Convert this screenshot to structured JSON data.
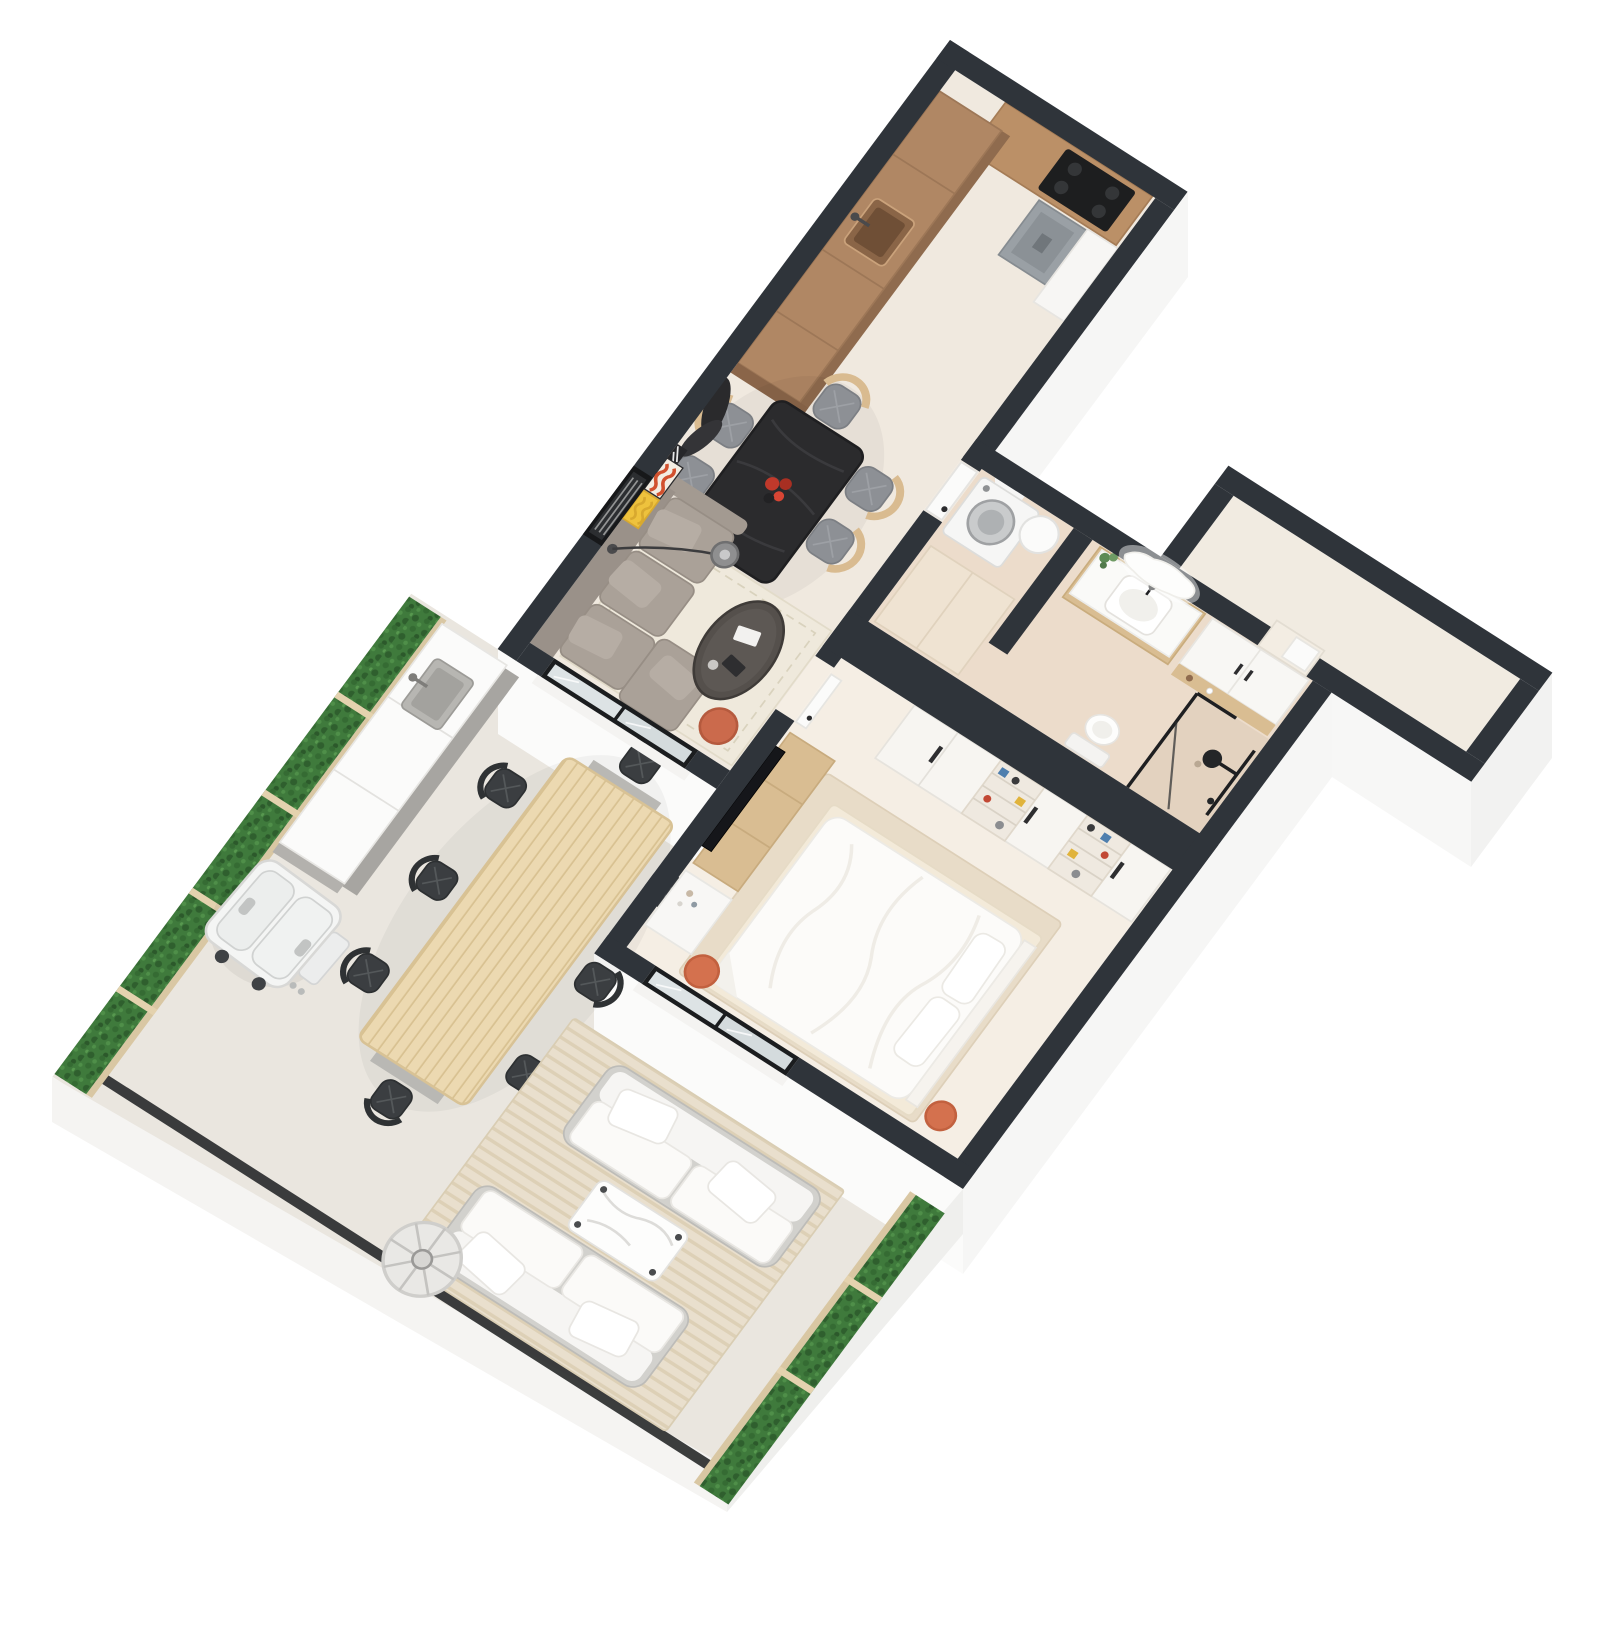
{
  "scene": {
    "type": "3d-floor-plan",
    "projection": "axonometric-top-down",
    "description": "3D axonometric floor plan of a one-bedroom apartment with open kitchen-dining-living area, bedroom, bathroom with laundry, empty storage room, and a large furnished terrace bordered by hedges",
    "background": "#ffffff"
  },
  "palette": {
    "wall_cut": "#2f343a",
    "window_frame": "#1a1d1f",
    "exterior_face": "#f8f8f7",
    "slab_edge": "#f1f0ee",
    "floor_main": "#f0e9df",
    "floor_bedroom": "#f5eee4",
    "floor_bathroom": "#ecdccb",
    "floor_storage": "#f1ebe1",
    "floor_terrace": "#eae6df",
    "wood_dark": "#b08764",
    "wood_light": "#d9bb90",
    "outdoor_wood": "#ecd9b1",
    "table_black": "#2b2b2d",
    "sofa_gray": "#a9a098",
    "rug_cream": "#efe9dc",
    "accent_orange": "#cd6c4b",
    "accent_red": "#c0392b",
    "accent_yellow": "#eec23d",
    "hedge_green": "#3f7a3c",
    "glass": "#dde3e5",
    "white_furniture": "#f8f7f5"
  },
  "rooms": [
    {
      "name": "kitchen",
      "furniture": [
        "wood cabinet run with sink",
        "top counter with black cooktop",
        "gray range hood",
        "white radiator panel",
        "white tall cabinet"
      ]
    },
    {
      "name": "dining-area",
      "furniture": [
        "black dining table",
        "red flower centerpiece",
        "6 wood chairs with gray seats",
        "dark leaf wall art"
      ]
    },
    {
      "name": "living-room",
      "furniture": [
        "gray sofa with chaise",
        "arc floor lamp",
        "dark oval coffee table",
        "cream rug",
        "orange pouf",
        "leaning wall art (stripes, orange, yellow)",
        "window with blinds"
      ]
    },
    {
      "name": "bedroom",
      "furniture": [
        "double bed with white duvet and two pillows",
        "beige rug",
        "wall TV",
        "wood media console",
        "white desk",
        "wardrobe wall with open shelves and colorful items",
        "2 orange stools"
      ]
    },
    {
      "name": "bathroom",
      "furniture": [
        "washing machine",
        "boiler cylinder",
        "beige tall cabinet",
        "wood vanity with white basin",
        "organic backlit mirror",
        "plant",
        "white wall cabinets",
        "toilet",
        "walk-in shower with black fixtures and glass"
      ]
    },
    {
      "name": "storage-room",
      "furniture": []
    },
    {
      "name": "terrace",
      "furniture": [
        "outdoor kitchen counter with sink",
        "white BBQ grill",
        "slatted wood dining table",
        "8 black outdoor chairs",
        "2 white outdoor sofas",
        "white marble coffee table",
        "striped outdoor rug",
        "cylindrical floor lamp",
        "hedge planters",
        "black edge rail"
      ]
    }
  ],
  "counts": {
    "dining_chairs": 6,
    "outdoor_chairs": 8,
    "outdoor_sofas": 2,
    "orange_stools": 2,
    "wardrobe_shelf_columns": 2
  }
}
